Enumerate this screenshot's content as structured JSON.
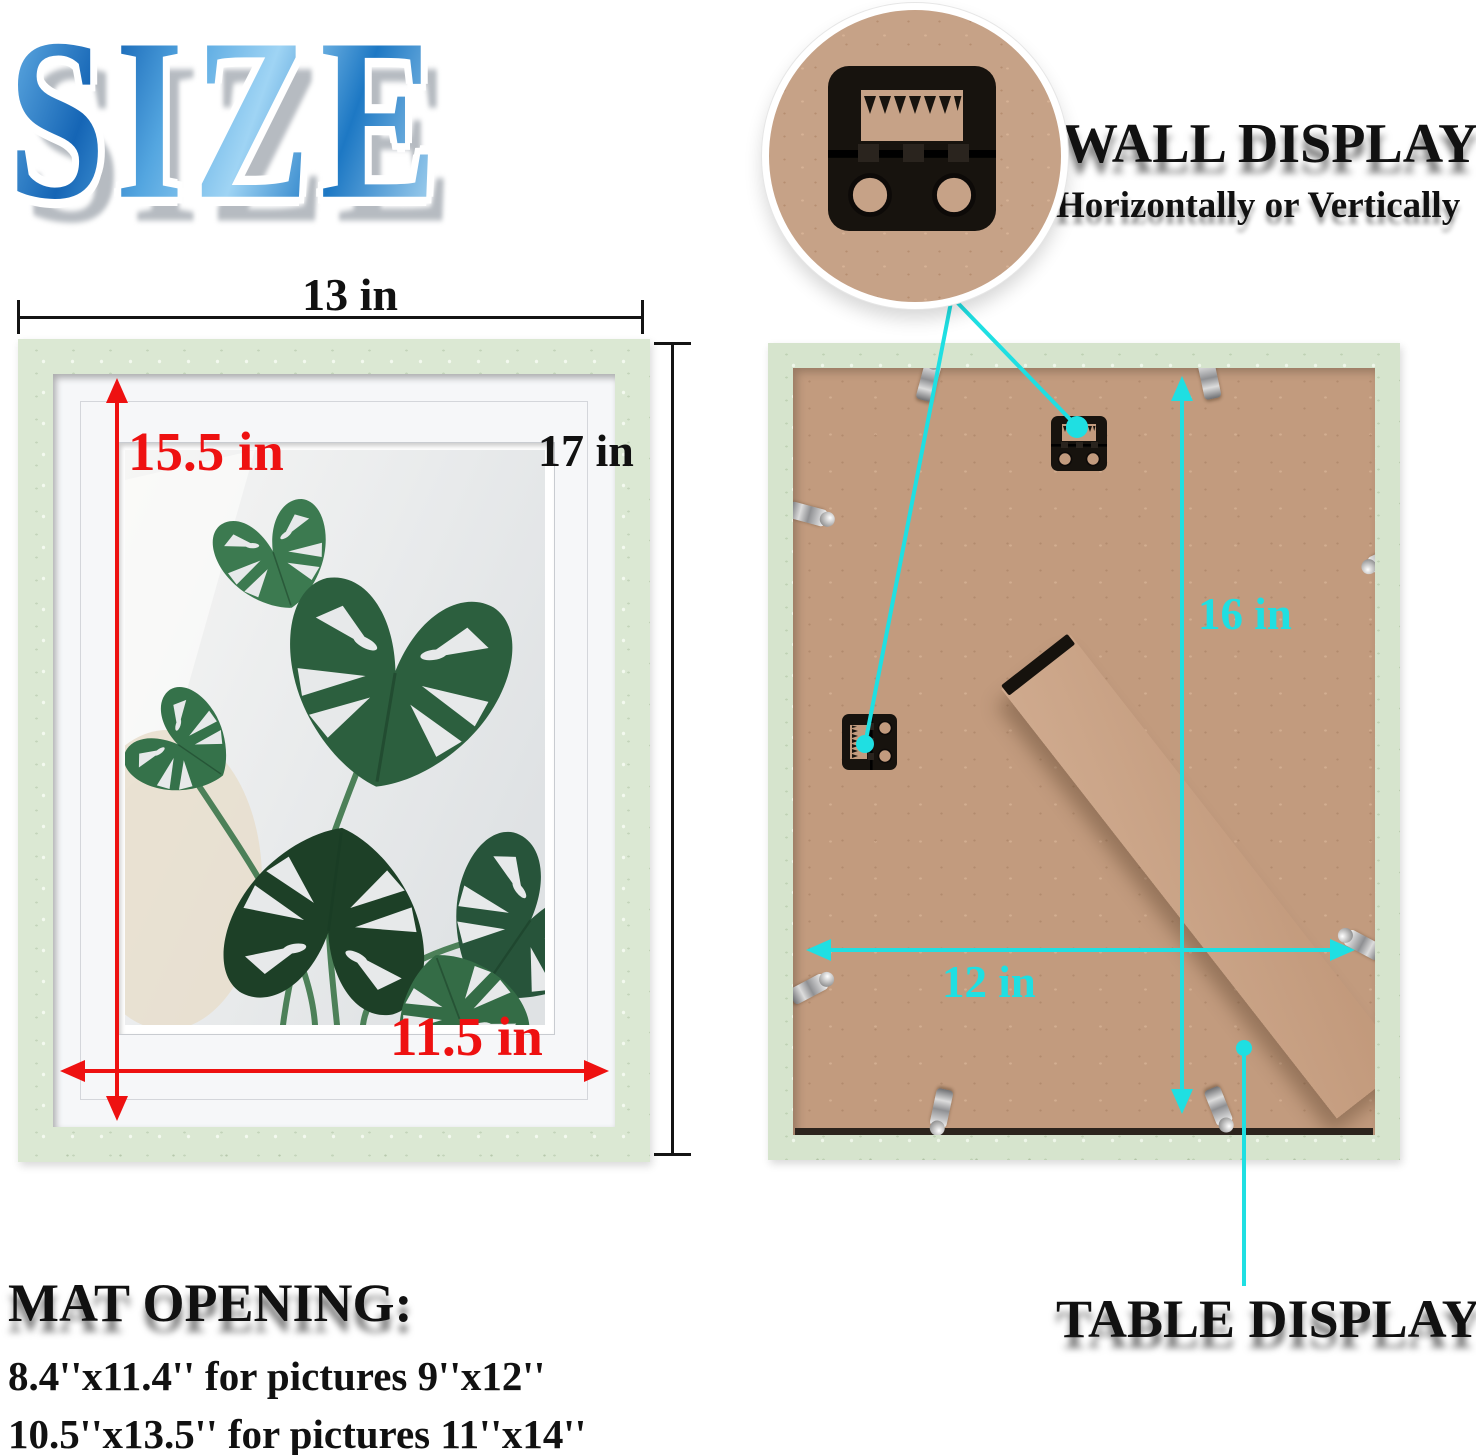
{
  "title": {
    "text": "SIZE"
  },
  "wall_display": {
    "title": "WALL DISPLAY",
    "subtitle": "Horizontally or Vertically",
    "icon": "sawtooth-hanger-icon"
  },
  "table_display": {
    "title": "TABLE DISPLAY"
  },
  "mat_opening": {
    "title": "MAT OPENING:",
    "lines": [
      "8.4''x11.4'' for pictures 9''x12''",
      "10.5''x13.5'' for pictures 11''x14''"
    ]
  },
  "front_frame": {
    "width_label": "13 in",
    "height_label": "17 in",
    "mat_height_label": "15.5 in",
    "mat_width_label": "11.5 in",
    "photo": "monstera-plant-photo"
  },
  "back_frame": {
    "height_label": "16 in",
    "width_label": "12 in",
    "hardware": [
      "sawtooth-hanger-icon",
      "metal-clip-icon",
      "easel-stand-leg"
    ]
  },
  "colors": {
    "accent_cyan": "#1fdfe2",
    "accent_red": "#ee1111",
    "frame_green": "#dbe8d3",
    "kraft_brown": "#c29b7e",
    "title_blue": "#2b85cc"
  }
}
